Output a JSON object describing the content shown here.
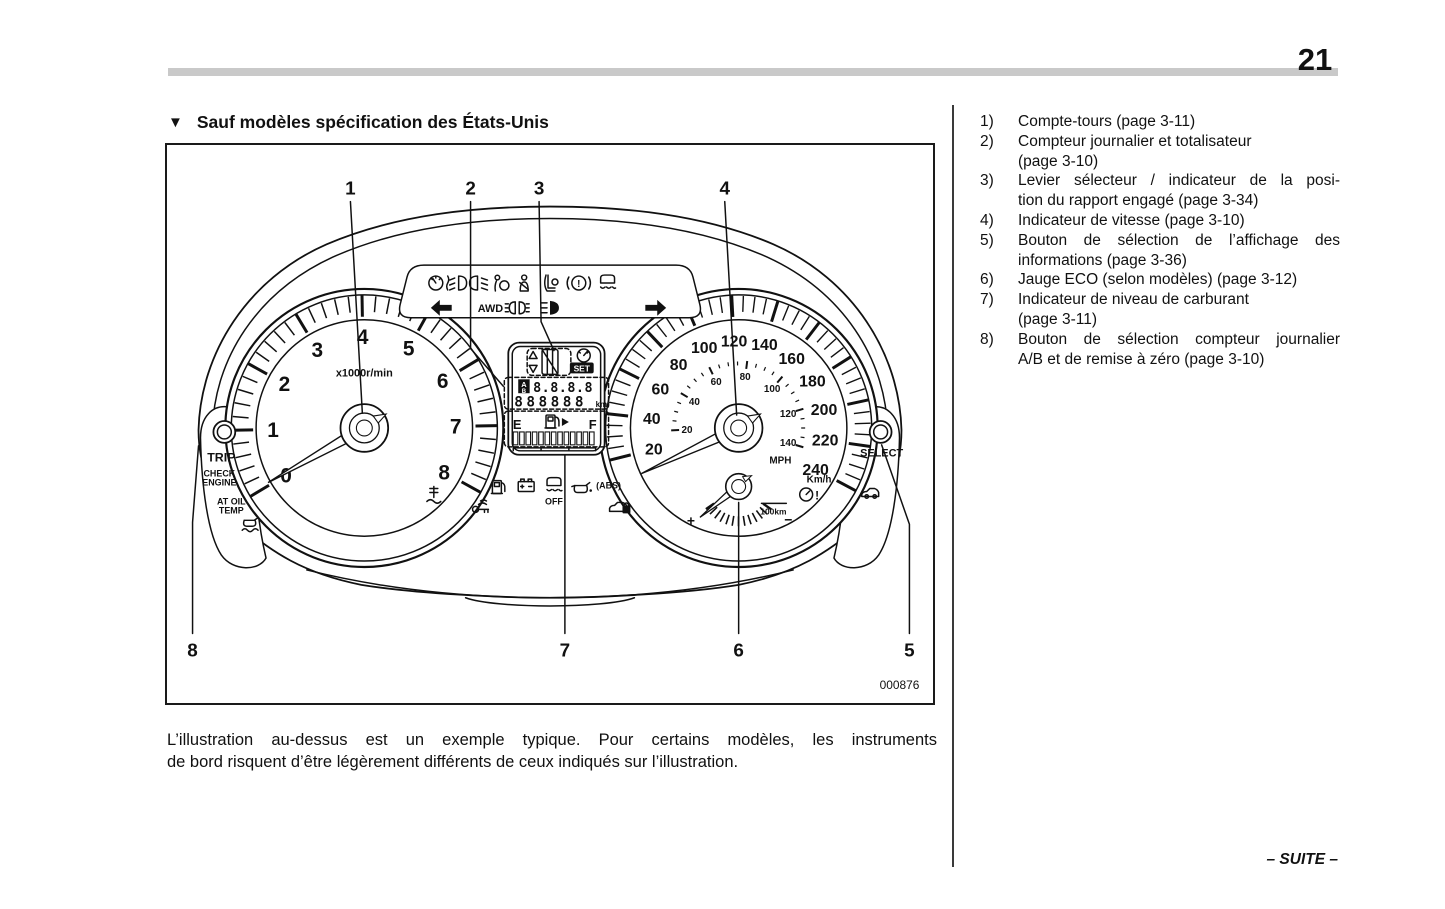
{
  "page": {
    "number": "21",
    "footer": "– SUITE –"
  },
  "section": {
    "marker": "▼",
    "title": "Sauf modèles spécification des États-Unis"
  },
  "figure": {
    "code": "000876",
    "callouts": {
      "c1": "1",
      "c2": "2",
      "c3": "3",
      "c4": "4",
      "c5": "5",
      "c6": "6",
      "c7": "7",
      "c8": "8"
    },
    "tachometer": {
      "numbers": [
        0,
        1,
        2,
        3,
        4,
        5,
        6,
        7,
        8
      ],
      "unit": "x1000r/min"
    },
    "speedometer": {
      "kmh_numbers": [
        20,
        40,
        60,
        80,
        100,
        120,
        140,
        160,
        180,
        200,
        220,
        240
      ],
      "mph_numbers": [
        20,
        40,
        60,
        80,
        100,
        120,
        140
      ],
      "mph_label": "MPH",
      "kmh_label": "Km/h"
    },
    "eco_gauge": {
      "plus": "+",
      "minus": "−",
      "unit": "100km"
    },
    "display": {
      "trip_selector": "A",
      "trip_selector_alt": "B",
      "trip_value": "8.8.8.8",
      "odometer_value": "888888",
      "odometer_unit": "km",
      "set_label": "SET",
      "fuel_empty": "E",
      "fuel_full": "F"
    },
    "left_panel": {
      "trip_label": "TRIP",
      "check_line1": "CHECK",
      "check_line2": "ENGINE",
      "at_oil_line1": "AT OIL",
      "at_oil_line2": "TEMP"
    },
    "right_panel": {
      "select_label": "SELECT"
    },
    "indicators": {
      "awd": "AWD",
      "vdc_off": "OFF",
      "abs": "(ABS)",
      "warn_mark": "!"
    }
  },
  "caption": {
    "lines": [
      "L’illustration au-dessus est un exemple typique. Pour certains modèles, les instruments",
      "de bord risquent d’être légèrement différents de ceux indiqués sur l’illustration."
    ]
  },
  "list": {
    "items": [
      {
        "num": "1)",
        "lines": [
          "Compte-tours (page 3-11)"
        ],
        "justify": false
      },
      {
        "num": "2)",
        "lines": [
          "Compteur journalier et totalisateur",
          "(page 3-10)"
        ],
        "justify": false
      },
      {
        "num": "3)",
        "lines": [
          "Levier sélecteur / indicateur de la posi-",
          "tion du rapport engagé (page 3-34)"
        ],
        "justify": true
      },
      {
        "num": "4)",
        "lines": [
          "Indicateur de vitesse (page 3-10)"
        ],
        "justify": false
      },
      {
        "num": "5)",
        "lines": [
          "Bouton de sélection de l’affichage des",
          "informations (page 3-36)"
        ],
        "justify": true
      },
      {
        "num": "6)",
        "lines": [
          "Jauge ECO (selon modèles) (page 3-12)"
        ],
        "justify": false
      },
      {
        "num": "7)",
        "lines": [
          "Indicateur de niveau de carburant",
          "(page 3-11)"
        ],
        "justify": false
      },
      {
        "num": "8)",
        "lines": [
          "Bouton de sélection compteur journalier",
          "A/B et de remise à zéro (page 3-10)"
        ],
        "justify": true
      }
    ]
  },
  "colors": {
    "ink": "#111111",
    "header_bar": "#c9c9c9",
    "page_bg": "#ffffff"
  }
}
